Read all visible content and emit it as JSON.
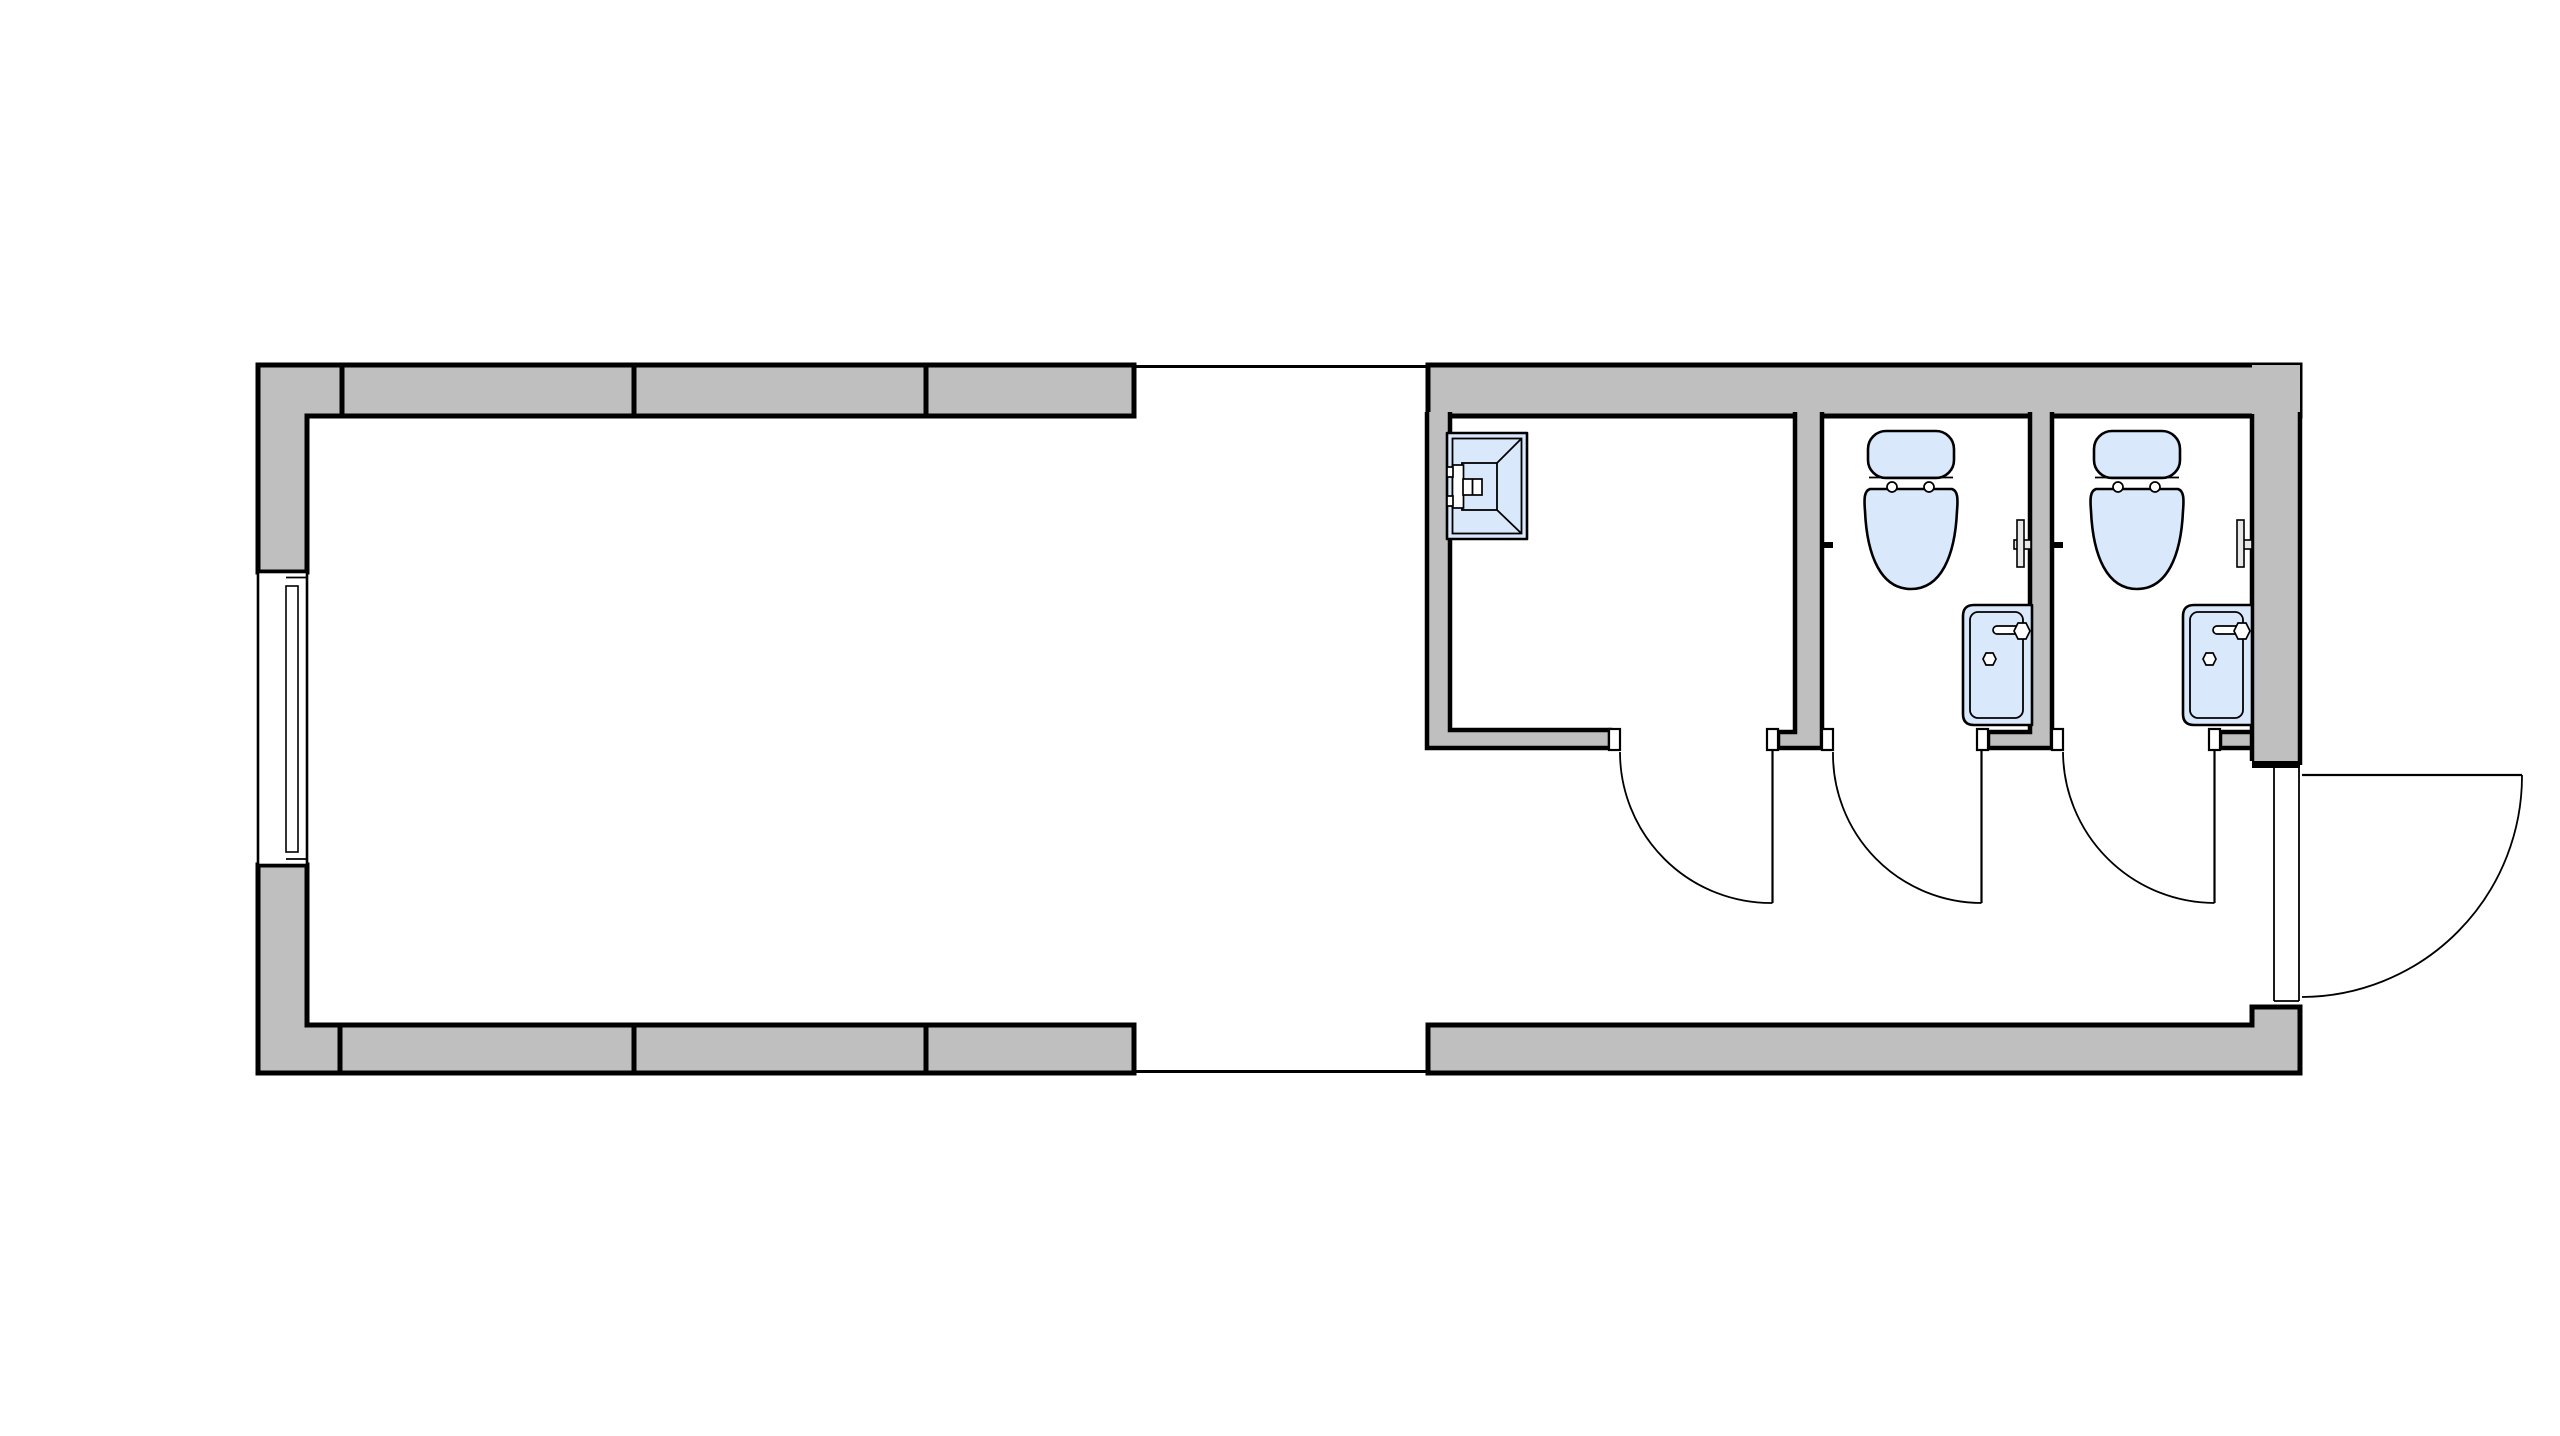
{
  "drawing": {
    "kind": "architectural-floor-plan",
    "rooms": [
      {
        "id": "main-room",
        "fixtures": []
      },
      {
        "id": "shower-room",
        "fixtures": [
          "shower"
        ]
      },
      {
        "id": "toilet-stall-1",
        "fixtures": [
          "toilet",
          "sink",
          "flush-valve"
        ]
      },
      {
        "id": "toilet-stall-2",
        "fixtures": [
          "toilet",
          "sink",
          "flush-valve"
        ]
      }
    ],
    "counts": {
      "windows": 1,
      "interior_doors": 3,
      "exterior_doors": 1,
      "toilets": 2,
      "sinks": 2,
      "showers": 1
    }
  },
  "colors": {
    "background": "#ffffff",
    "wall_fill": "#bfbfbf",
    "line": "#000000",
    "fixture_fill": "#d9e8fa",
    "jamb_fill": "#ffffff",
    "hardware_fill": "#e8e8e8"
  }
}
